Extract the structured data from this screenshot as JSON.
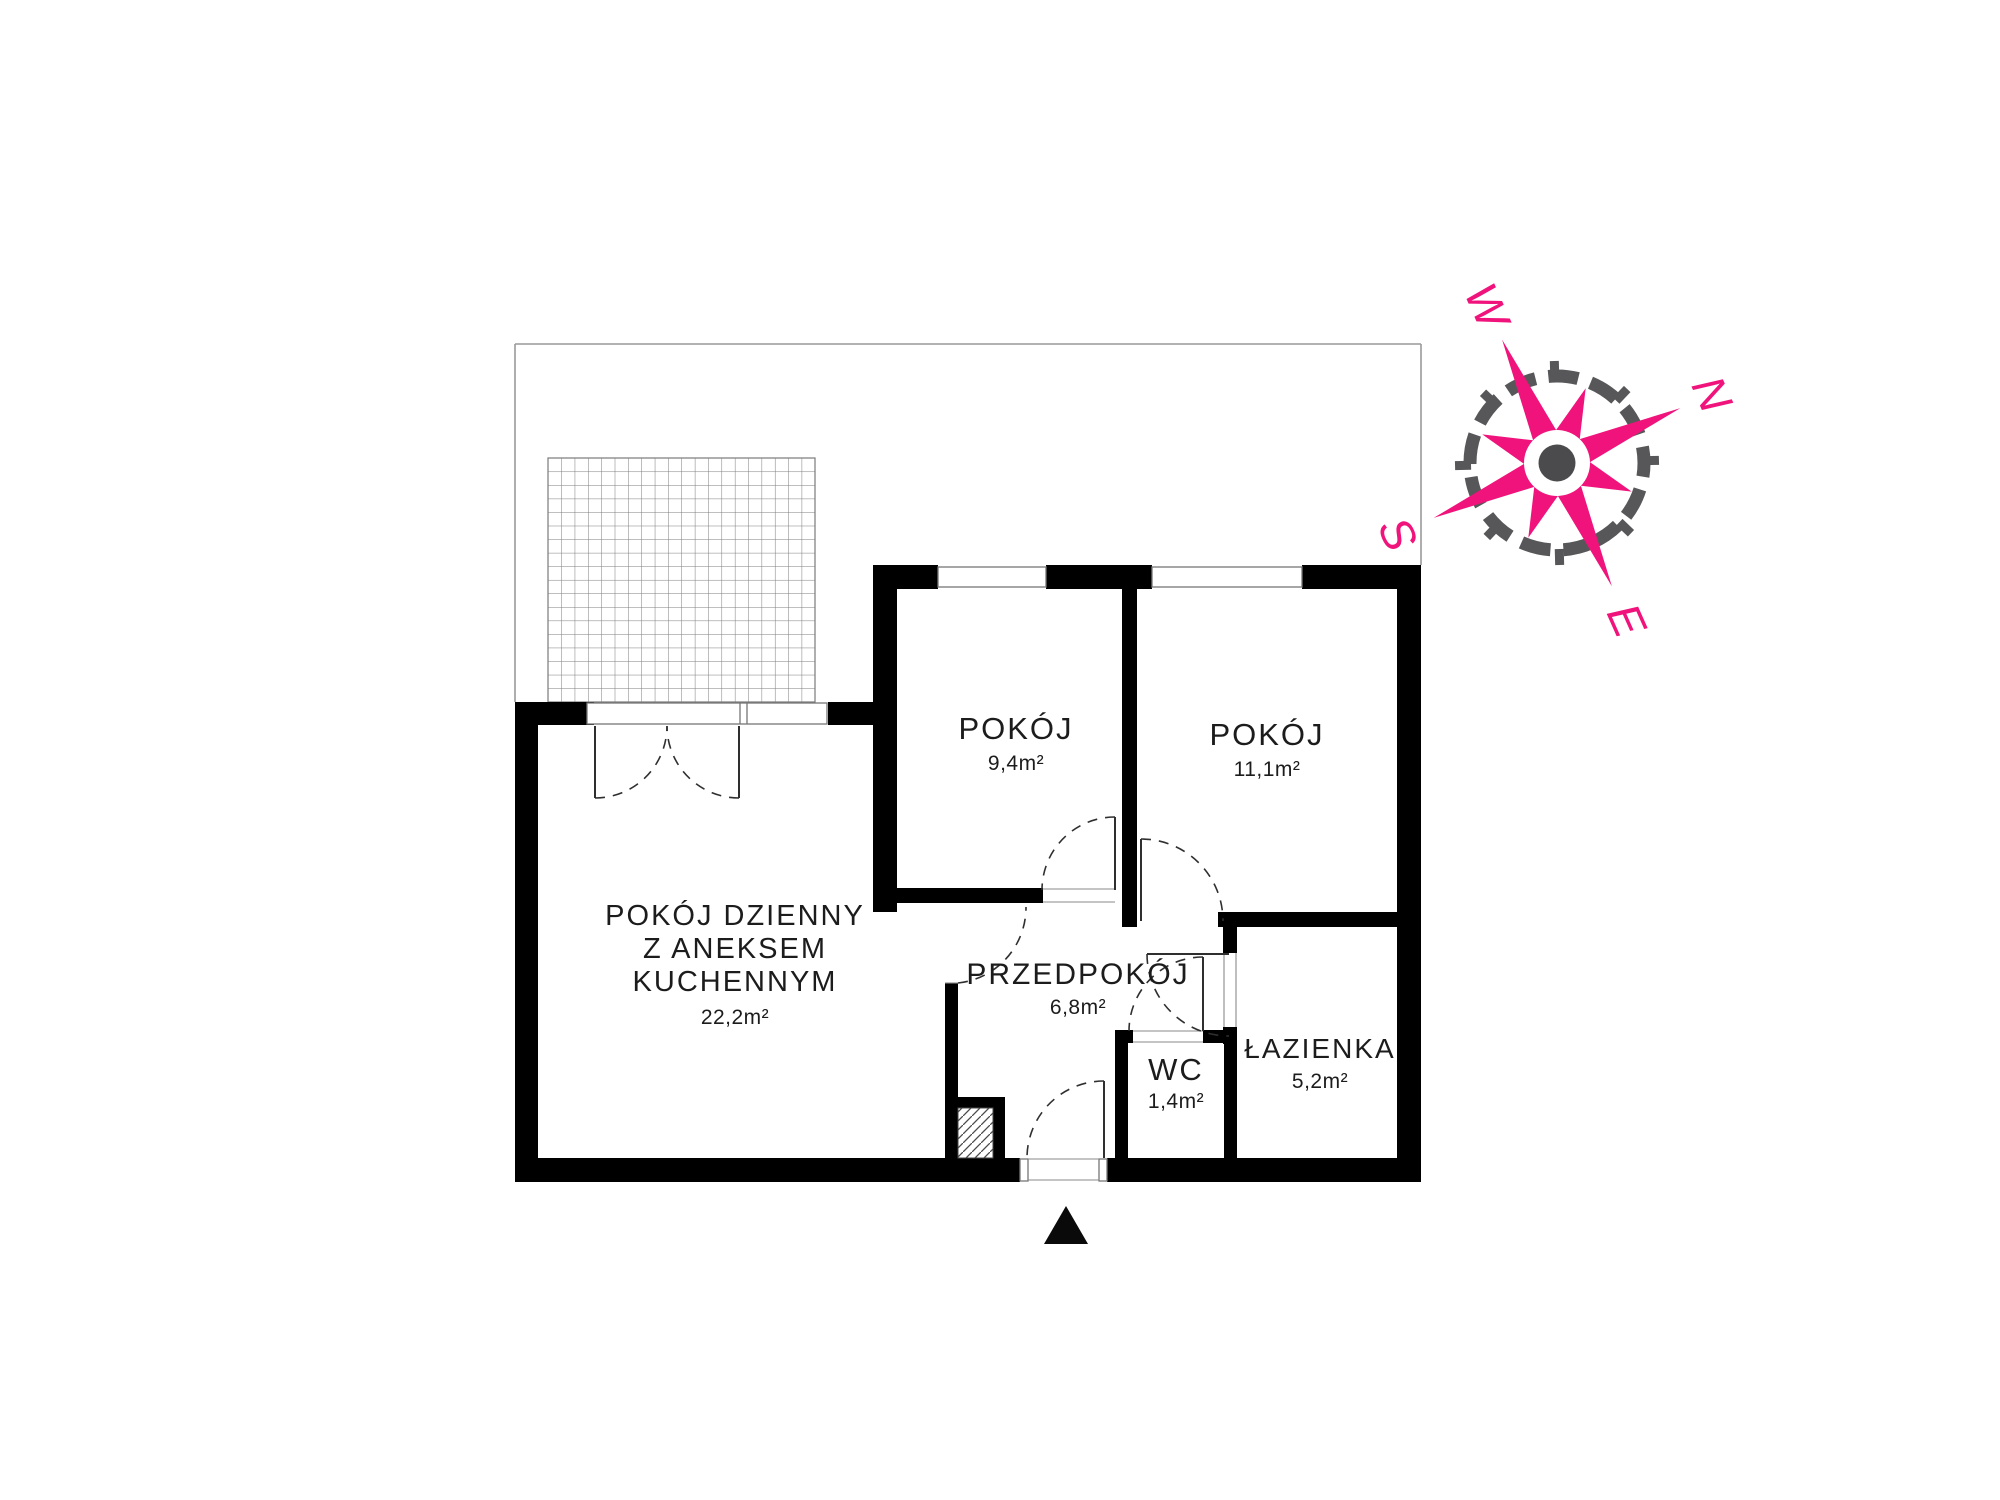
{
  "plan": {
    "title": "apartment-floor-plan",
    "rooms": [
      {
        "id": "living",
        "name_lines": [
          "POKÓJ DZIENNY",
          "Z ANEKSEM",
          "KUCHENNYM"
        ],
        "area": "22,2m²"
      },
      {
        "id": "room1",
        "name": "POKÓJ",
        "area": "9,4m²"
      },
      {
        "id": "room2",
        "name": "POKÓJ",
        "area": "11,1m²"
      },
      {
        "id": "hall",
        "name": "PRZEDPOKÓJ",
        "area": "6,8m²"
      },
      {
        "id": "wc",
        "name": "WC",
        "area": "1,4m²"
      },
      {
        "id": "bath",
        "name": "ŁAZIENKA",
        "area": "5,2m²"
      }
    ]
  },
  "compass": {
    "n": "N",
    "e": "E",
    "s": "S",
    "w": "W"
  },
  "colors": {
    "wall": "#000000",
    "thin_line": "#8a8a8a",
    "property_line": "#999999",
    "text": "#1c1c1c",
    "compass_pink": "#f0137b",
    "compass_ring": "#57575a",
    "compass_dot": "#4b4b4d"
  }
}
